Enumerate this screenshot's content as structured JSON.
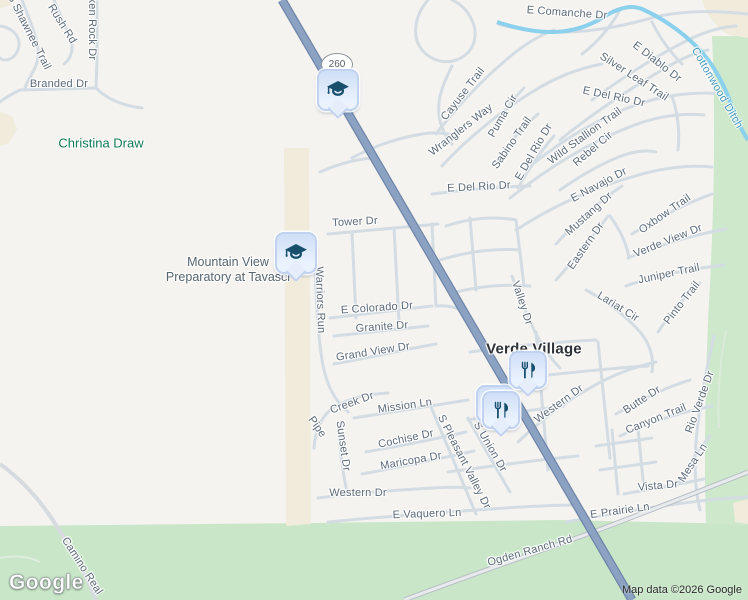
{
  "map": {
    "logo": "Google",
    "attribution": "Map data ©2026 Google",
    "route_shield": {
      "text": "260",
      "x": 336,
      "y": 64
    },
    "colors": {
      "background": "#f5f3f0",
      "minor_road": "#d3dce3",
      "highway_fill": "#8ba2c3",
      "highway_casing": "#6f86a8",
      "water": "#8bd0ec",
      "green_area": "#c9e7c8",
      "sand_area": "#f0ebdb",
      "street_text": "#5d6b7a",
      "water_text": "#4a9ac1",
      "park_text": "#137a54",
      "locality_text": "#2e3237",
      "pin_fill": "#e0ebfc",
      "pin_glyph": "#174f6d"
    },
    "labels": [
      {
        "kind": "street",
        "id": "s-shawnee-trail",
        "text": "S Shawnee Trail",
        "x": 29,
        "y": 32,
        "rot": 63
      },
      {
        "kind": "street",
        "id": "rush-rd",
        "text": "Rush Rd",
        "x": 62,
        "y": 24,
        "rot": 58
      },
      {
        "kind": "street",
        "id": "broken-rock-dr",
        "text": "Broken Rock Dr",
        "x": 92,
        "y": 20,
        "rot": 90
      },
      {
        "kind": "street",
        "id": "branded-dr",
        "text": "Branded Dr",
        "x": 59,
        "y": 84,
        "rot": 0
      },
      {
        "kind": "street",
        "id": "e-comanche-dr",
        "text": "E Comanche Dr",
        "x": 567,
        "y": 13,
        "rot": 4
      },
      {
        "kind": "street",
        "id": "e-diablo-dr",
        "text": "E Diablo Dr",
        "x": 657,
        "y": 62,
        "rot": 38
      },
      {
        "kind": "street",
        "id": "silver-leaf-trail",
        "text": "Silver Leaf Trail",
        "x": 634,
        "y": 77,
        "rot": 33
      },
      {
        "kind": "street",
        "id": "cayuse-trail",
        "text": "Cayuse Trail",
        "x": 463,
        "y": 94,
        "rot": -52
      },
      {
        "kind": "street",
        "id": "wranglers-way",
        "text": "Wranglers Way",
        "x": 461,
        "y": 130,
        "rot": -38
      },
      {
        "kind": "street",
        "id": "puma-cir",
        "text": "Puma Cir",
        "x": 503,
        "y": 116,
        "rot": -60
      },
      {
        "kind": "street",
        "id": "sabino-trail",
        "text": "Sabino Trail",
        "x": 512,
        "y": 143,
        "rot": -55
      },
      {
        "kind": "street",
        "id": "e-del-rio-dr-north",
        "text": "E Del Rio Dr",
        "x": 614,
        "y": 97,
        "rot": 12
      },
      {
        "kind": "street",
        "id": "e-del-rio-dr-west",
        "text": "E Del Rio Dr",
        "x": 534,
        "y": 152,
        "rot": -60
      },
      {
        "kind": "street",
        "id": "e-del-rio-dr-south",
        "text": "E Del Rio Dr",
        "x": 479,
        "y": 187,
        "rot": -3
      },
      {
        "kind": "street",
        "id": "wild-stallion-trail",
        "text": "Wild Stallion Trail",
        "x": 585,
        "y": 136,
        "rot": -36
      },
      {
        "kind": "street",
        "id": "rebel-cir",
        "text": "Rebel Cir",
        "x": 593,
        "y": 149,
        "rot": -40
      },
      {
        "kind": "street",
        "id": "e-navajo-dr",
        "text": "E Navajo Dr",
        "x": 599,
        "y": 185,
        "rot": -28
      },
      {
        "kind": "street",
        "id": "tower-dr",
        "text": "Tower Dr",
        "x": 355,
        "y": 222,
        "rot": -3
      },
      {
        "kind": "street",
        "id": "mustang-dr",
        "text": "Mustang Dr",
        "x": 589,
        "y": 214,
        "rot": -42
      },
      {
        "kind": "street",
        "id": "eastern-dr",
        "text": "Eastern Dr",
        "x": 586,
        "y": 246,
        "rot": -55
      },
      {
        "kind": "street",
        "id": "oxbow-trail",
        "text": "Oxbow Trail",
        "x": 665,
        "y": 214,
        "rot": -35
      },
      {
        "kind": "street",
        "id": "verde-view-dr",
        "text": "Verde View Dr",
        "x": 668,
        "y": 241,
        "rot": -22
      },
      {
        "kind": "street",
        "id": "juniper-trail",
        "text": "Juniper Trail",
        "x": 669,
        "y": 274,
        "rot": -12
      },
      {
        "kind": "street",
        "id": "lariat-cir",
        "text": "Lariat Cir",
        "x": 618,
        "y": 307,
        "rot": 32
      },
      {
        "kind": "street",
        "id": "pinto-trail",
        "text": "Pinto Trail",
        "x": 682,
        "y": 303,
        "rot": -52
      },
      {
        "kind": "street",
        "id": "valley-dr",
        "text": "Valley Dr",
        "x": 522,
        "y": 303,
        "rot": 72
      },
      {
        "kind": "street",
        "id": "warriors-run",
        "text": "Warriors Run",
        "x": 320,
        "y": 300,
        "rot": 88
      },
      {
        "kind": "street",
        "id": "e-colorado-dr",
        "text": "E Colorado Dr",
        "x": 377,
        "y": 308,
        "rot": -4
      },
      {
        "kind": "street",
        "id": "granite-dr",
        "text": "Granite Dr",
        "x": 382,
        "y": 327,
        "rot": -4
      },
      {
        "kind": "street",
        "id": "grand-view-dr",
        "text": "Grand View Dr",
        "x": 373,
        "y": 352,
        "rot": -9
      },
      {
        "kind": "street",
        "id": "butte-dr",
        "text": "Butte Dr",
        "x": 642,
        "y": 400,
        "rot": -33
      },
      {
        "kind": "street",
        "id": "canyon-trail",
        "text": "Canyon Trail",
        "x": 656,
        "y": 419,
        "rot": -22
      },
      {
        "kind": "street",
        "id": "rio-verde-dr",
        "text": "Rio Verde Dr",
        "x": 700,
        "y": 402,
        "rot": -70
      },
      {
        "kind": "street",
        "id": "mesa-ln",
        "text": "Mesa Ln",
        "x": 693,
        "y": 463,
        "rot": -57
      },
      {
        "kind": "street",
        "id": "vista-dr",
        "text": "Vista Dr",
        "x": 658,
        "y": 486,
        "rot": -5
      },
      {
        "kind": "street",
        "id": "e-prairie-ln",
        "text": "E Prairie Ln",
        "x": 620,
        "y": 511,
        "rot": -8
      },
      {
        "kind": "street",
        "id": "western-dr-ne",
        "text": "Western Dr",
        "x": 559,
        "y": 404,
        "rot": -36
      },
      {
        "kind": "street",
        "id": "mission-ln",
        "text": "Mission Ln",
        "x": 405,
        "y": 406,
        "rot": -8
      },
      {
        "kind": "street",
        "id": "pipe-creek-dr-a",
        "text": "Pipe",
        "x": 317,
        "y": 427,
        "rot": 55
      },
      {
        "kind": "street",
        "id": "pipe-creek-dr-b",
        "text": "Creek Dr",
        "x": 352,
        "y": 403,
        "rot": -20
      },
      {
        "kind": "street",
        "id": "sunset-dr",
        "text": "Sunset Dr",
        "x": 343,
        "y": 446,
        "rot": 82
      },
      {
        "kind": "street",
        "id": "cochise-dr",
        "text": "Cochise Dr",
        "x": 406,
        "y": 439,
        "rot": -12
      },
      {
        "kind": "street",
        "id": "maricopa-dr",
        "text": "Maricopa Dr",
        "x": 411,
        "y": 461,
        "rot": -10
      },
      {
        "kind": "street",
        "id": "s-pleasant-valley-dr",
        "text": "S Pleasant Valley Dr",
        "x": 464,
        "y": 462,
        "rot": 63
      },
      {
        "kind": "street",
        "id": "s-union-dr",
        "text": "S Union Dr",
        "x": 490,
        "y": 447,
        "rot": 60
      },
      {
        "kind": "street",
        "id": "western-dr-sw",
        "text": "Western Dr",
        "x": 358,
        "y": 493,
        "rot": 0
      },
      {
        "kind": "street",
        "id": "e-vaquero-ln",
        "text": "E Vaquero Ln",
        "x": 427,
        "y": 514,
        "rot": -2
      },
      {
        "kind": "street",
        "id": "camino-real",
        "text": "Camino Real",
        "x": 82,
        "y": 566,
        "rot": 57
      },
      {
        "kind": "street",
        "id": "ogden-ranch-rd",
        "text": "Ogden Ranch Rd",
        "x": 530,
        "y": 551,
        "rot": -16
      },
      {
        "kind": "water",
        "id": "cottonwood-ditch",
        "text": "Cottonwood Ditch",
        "x": 717,
        "y": 88,
        "rot": 60
      },
      {
        "kind": "park",
        "id": "christina-draw",
        "text": "Christina Draw",
        "x": 101,
        "y": 143,
        "rot": 0
      },
      {
        "kind": "locality",
        "id": "verde-village",
        "text": "Verde Village",
        "x": 534,
        "y": 349,
        "rot": 0
      },
      {
        "kind": "poi",
        "id": "mountain-view-preparatory-at-tavasci",
        "lines": [
          "Mountain View",
          "Preparatory at Tavasci"
        ],
        "x": 228,
        "y": 270,
        "rot": 0
      }
    ],
    "markers": [
      {
        "id": "school-marker-260",
        "icon": "graduation-cap",
        "x": 336,
        "y": 88,
        "size": 38
      },
      {
        "id": "school-marker-tavasci",
        "icon": "graduation-cap",
        "x": 294,
        "y": 251,
        "size": 38
      },
      {
        "id": "restaurant-marker-north",
        "icon": "restaurant",
        "x": 526,
        "y": 368,
        "size": 34
      },
      {
        "id": "restaurant-marker-back",
        "icon": "restaurant",
        "x": 493,
        "y": 402,
        "size": 34
      },
      {
        "id": "restaurant-marker-front",
        "icon": "restaurant",
        "x": 499,
        "y": 408,
        "size": 34
      }
    ]
  }
}
